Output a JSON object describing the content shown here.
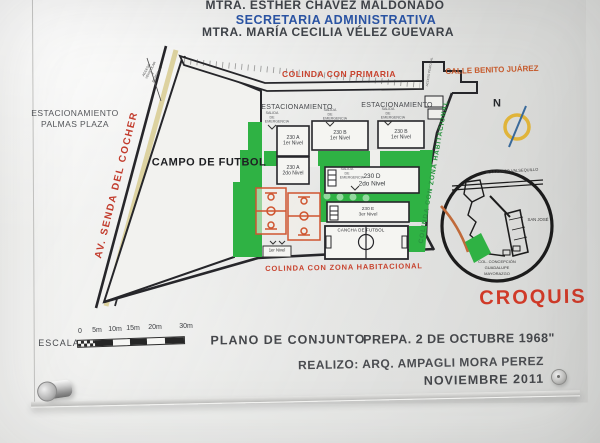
{
  "header": {
    "line1": "MTRA. ESTHER CHAVEZ MALDONADO",
    "line2": "SECRETARIA ADMINISTRATIVA",
    "line3": "MTRA. MARÍA CECILIA VÉLEZ GUEVARA"
  },
  "plan": {
    "parking_left": {
      "line1": "ESTACIONAMIENTO",
      "line2": "PALMAS PLAZA"
    },
    "street_diagonal": "AV. SENDA DEL COCHER",
    "access_note": "ACCESO VEHICULAR Y PEATONAL",
    "access_side": "ACCESO PEATONAL",
    "boundary_top": "COLINDA CON PRIMARIA",
    "street_top_right": "CALLE BENITO JUÁREZ",
    "parking_row": [
      "ESTACIONAMIENTO",
      "ESTACIONAMIENTO"
    ],
    "emergency_exit": "SALIDA DE EMERGENCIA",
    "field_main": "CAMPO DE FUTBOL",
    "field_small": "CANCHA DE FUTBOL",
    "court_level": "1er Nivel",
    "buildings": [
      {
        "id": "230 A",
        "level": "1er Nivel"
      },
      {
        "id": "230 B",
        "level": "1er Nivel"
      },
      {
        "id": "230 B",
        "level": "1er Nivel"
      },
      {
        "id": "230 A",
        "level": "2do Nivel"
      },
      {
        "id": "230 D",
        "level": "2do Nivel"
      },
      {
        "id": "230 E",
        "level": "3er Nivel"
      }
    ],
    "boundary_bottom": "COLINDA CON ZONA HABITACIONAL",
    "boundary_right": "COLINDA CON ZONA HABITACIONAL",
    "compass_label": "N"
  },
  "inset": {
    "road_top": "BOULEVARD VALSEQUILLO",
    "area_right": "SAN JOSÉ",
    "area_bottom_1": "COL. CONCEPCIÓN",
    "area_bottom_2": "GUADALUPE",
    "area_bottom_3": "MAYORAZGO",
    "title": "CROQUIS"
  },
  "footer": {
    "scale_label": "ESCALA",
    "scale_ticks": [
      "0",
      "5m",
      "10m",
      "15m",
      "20m",
      "30m"
    ],
    "plan_title": "PLANO DE CONJUNTO",
    "school_title": "PREPA. 2 DE OCTUBRE 1968\"",
    "author": "REALIZO: ARQ. AMPAGLI MORA PEREZ",
    "date": "NOVIEMBRE 2011"
  },
  "colors": {
    "accent_red": "#c8432e",
    "accent_orange": "#c75c2e",
    "accent_blue": "#2a55a8",
    "accent_green": "#2fb244",
    "croquis_red": "#d03a28",
    "compass_ring": "#e0b43a"
  }
}
